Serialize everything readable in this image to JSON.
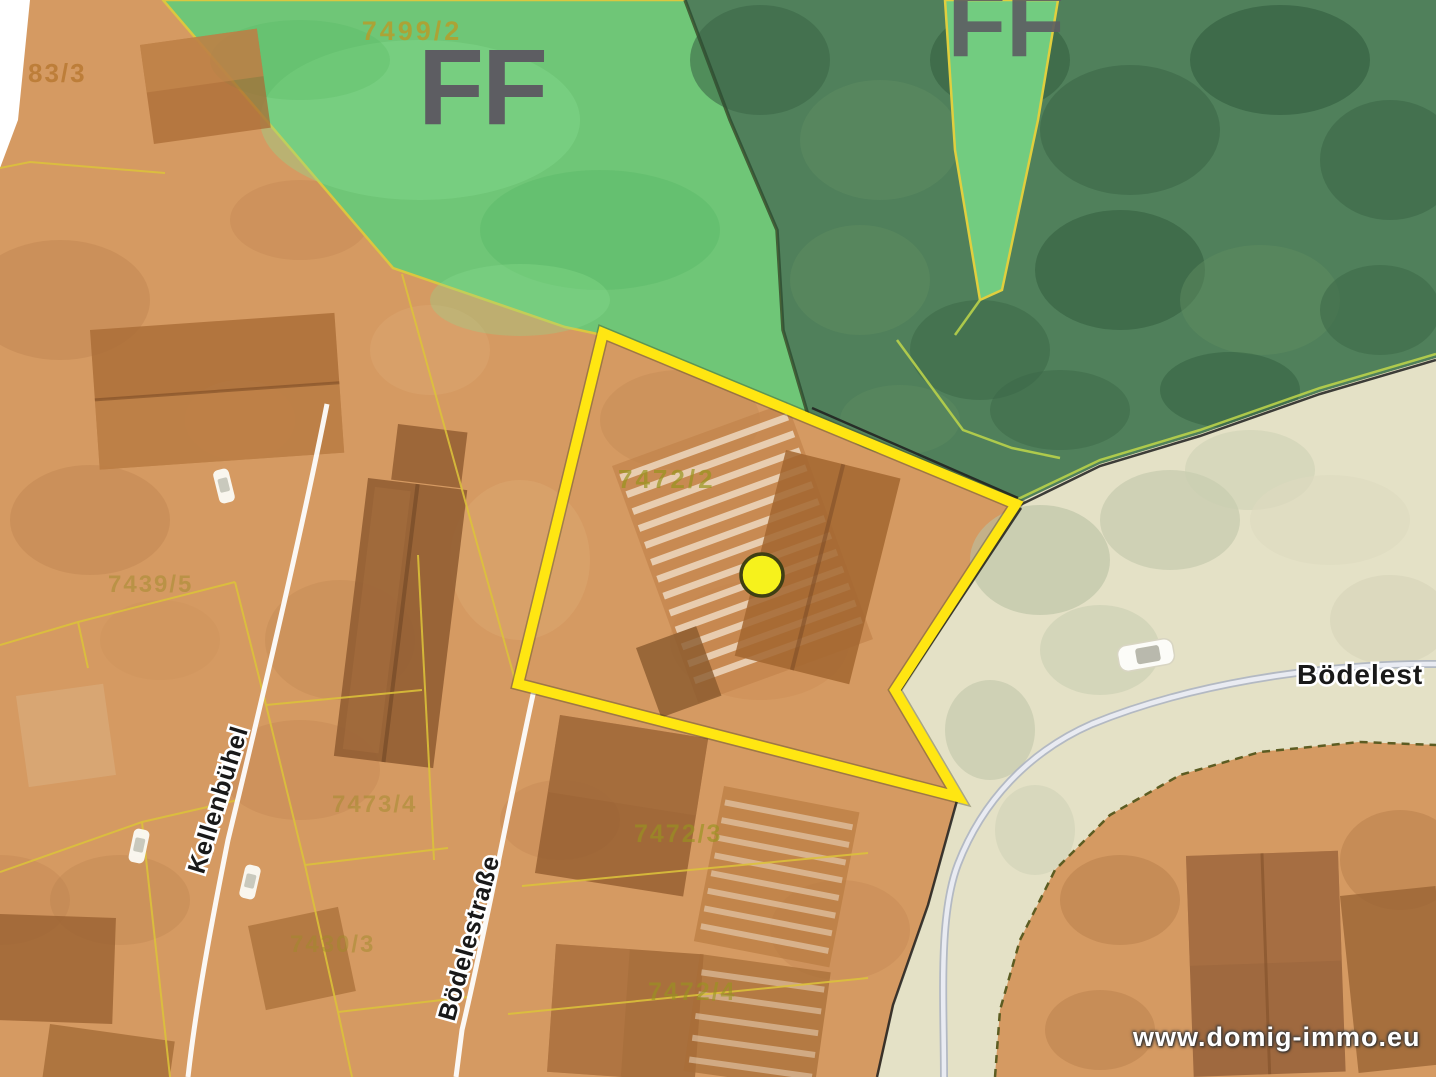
{
  "palette": {
    "highlight_border": "#ffe612",
    "selected_marker_fill": "#f6f21c",
    "parcel_line_yellow": "#dcc23a",
    "open_space_green": "#6cc878",
    "forest_green": "#50805b",
    "building_land_orange": "#d59a62",
    "road_corridor_beige": "#e4e1c6",
    "zone_label_gray": "#5d5d62",
    "parcel_number_olive": "#9a8e28"
  },
  "zone_labels": {
    "open_space_ff": "FF",
    "forest_clearing_ff": "FF"
  },
  "parcel_numbers": {
    "p_83_3": "83/3",
    "p_7499_2": "7499/2",
    "p_7439_5": "7439/5",
    "p_7472_2": "7472/2",
    "p_7473_4": "7473/4",
    "p_7472_3": "7472/3",
    "p_7430_3": "7430/3",
    "p_7472_4": "7472/4"
  },
  "street_labels": {
    "kellenbuehel": "Kellenbühel",
    "boedelestrasse": "Bödelestraße",
    "boedelestrasse_east_clipped": "Bödelest"
  },
  "watermark": {
    "text": "www.domig-immo.eu"
  }
}
